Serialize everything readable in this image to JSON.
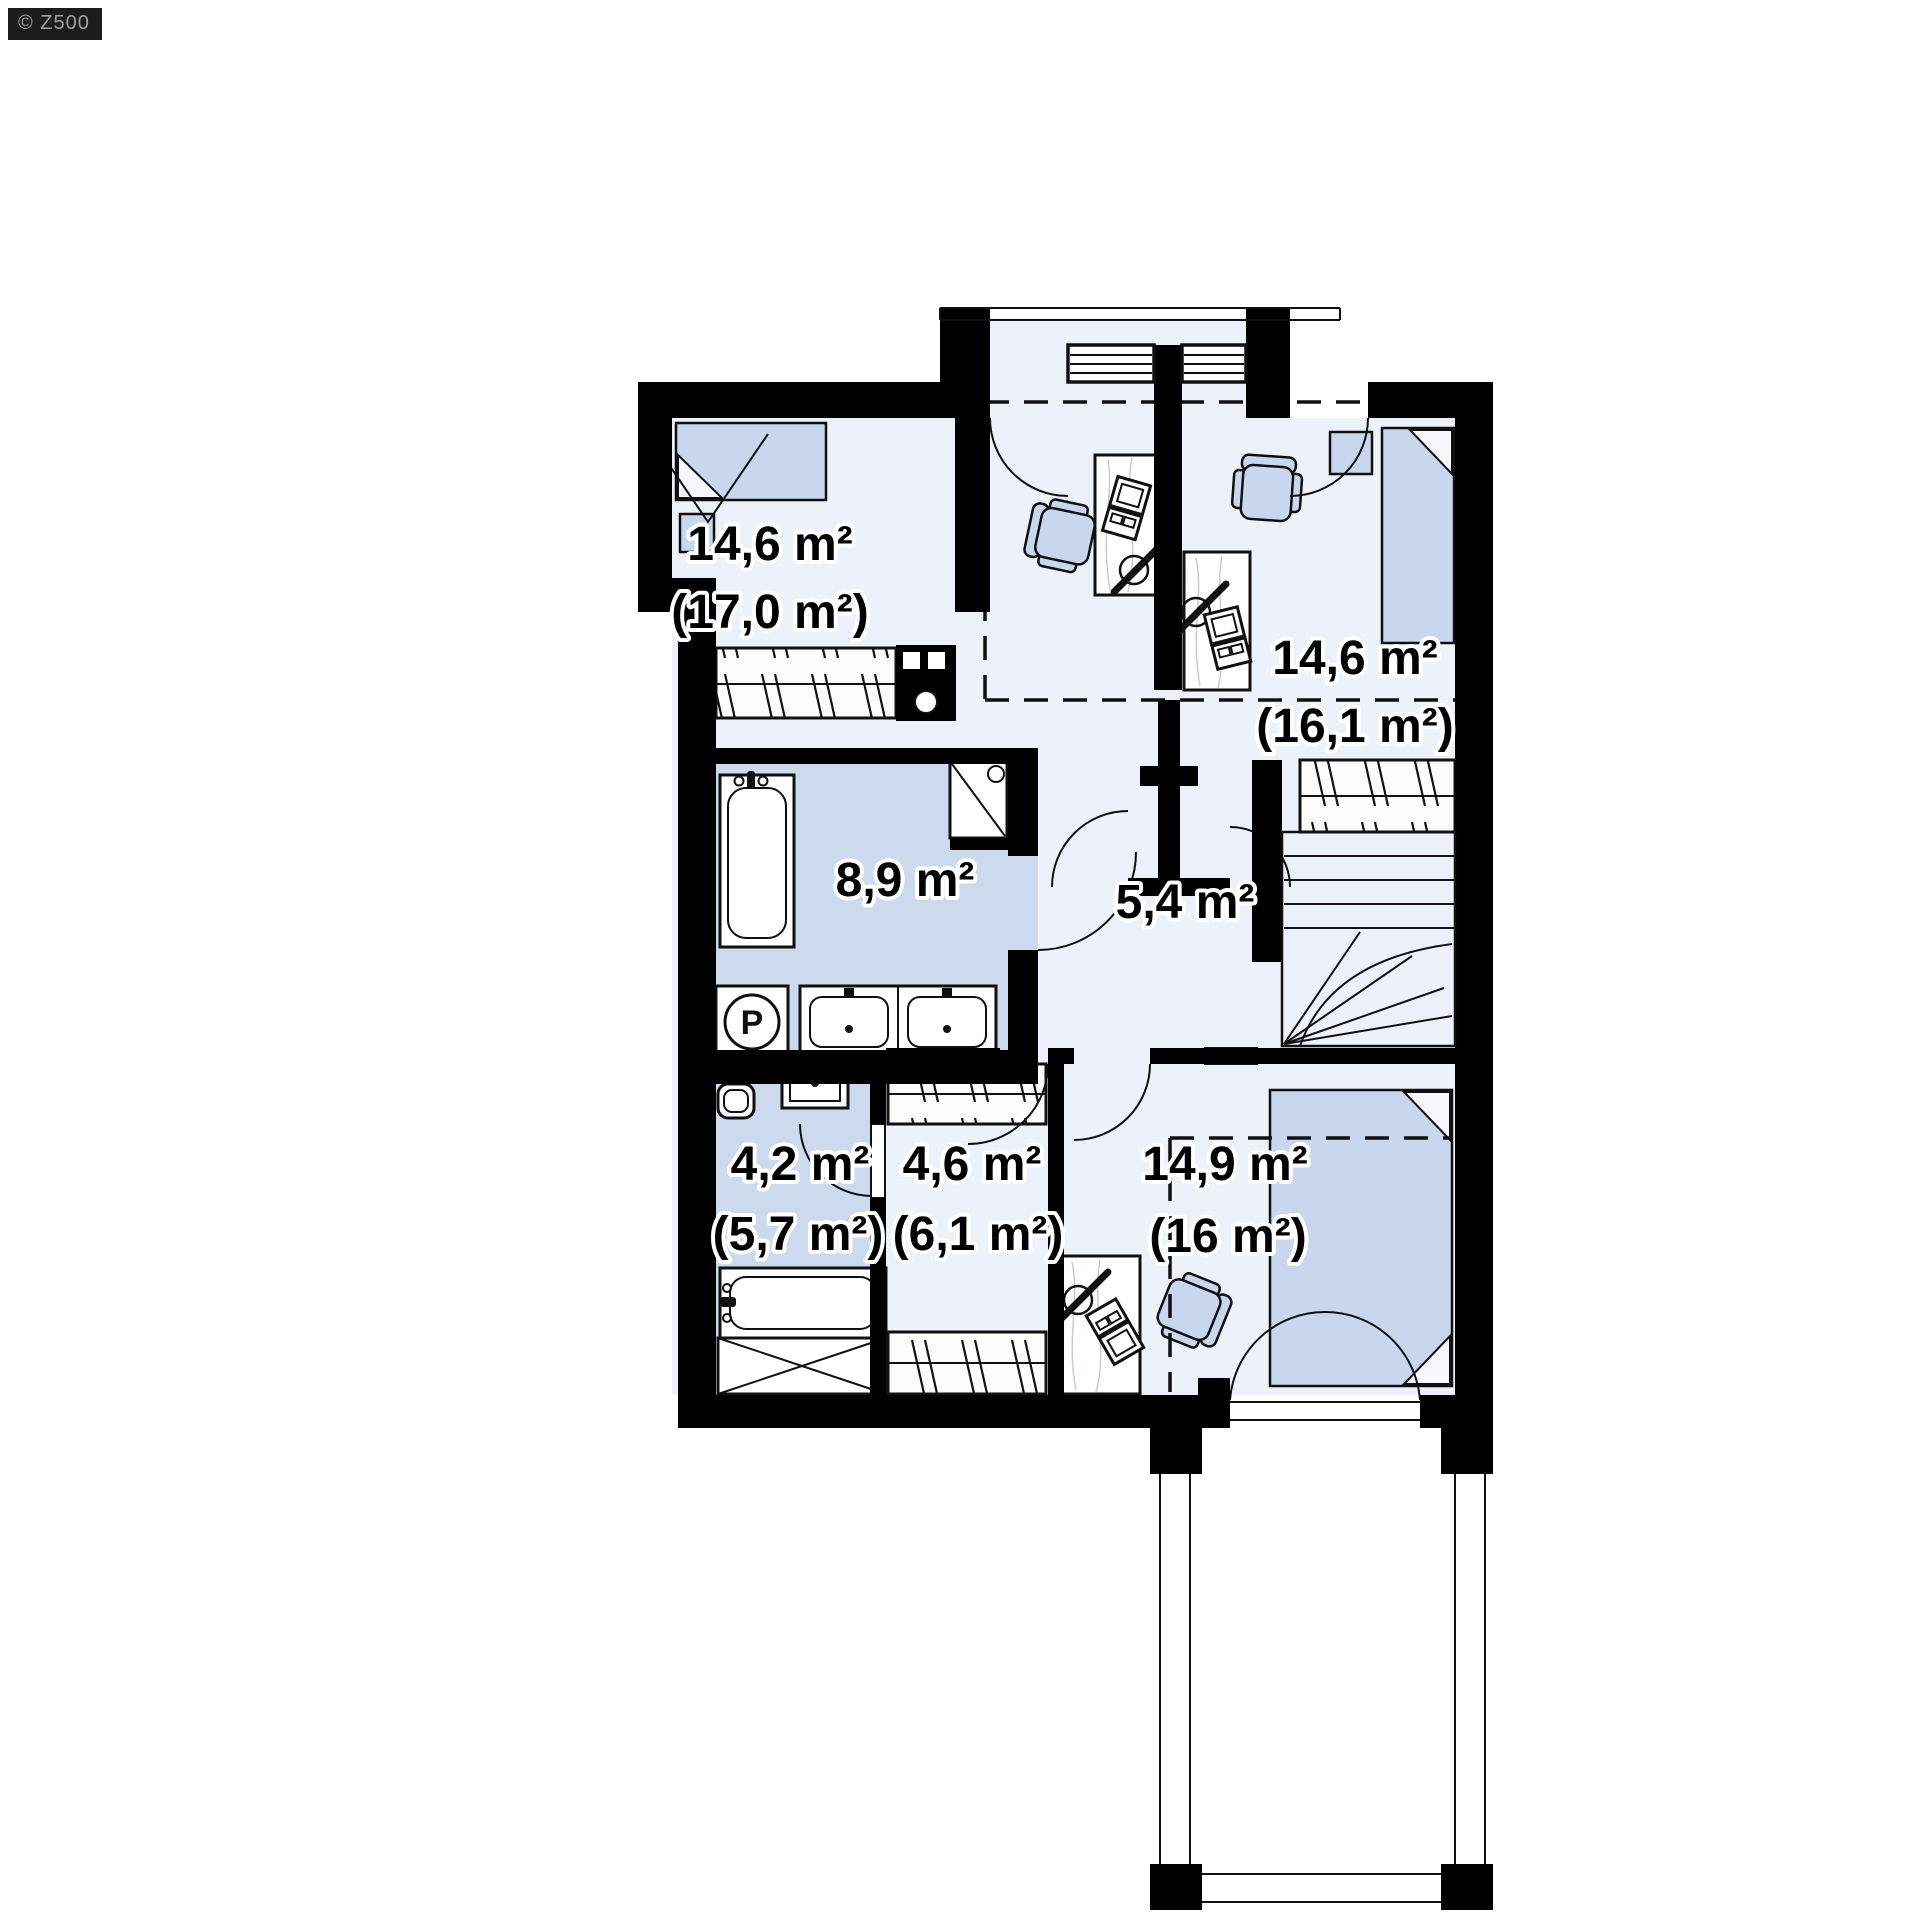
{
  "watermark": {
    "label": "© Z500"
  },
  "plan": {
    "type": "floor-plan-upper-storey",
    "rooms": [
      {
        "name": "bedroom-top-left",
        "area": "14,6 m²",
        "area_gross": "(17,0 m²)"
      },
      {
        "name": "bedroom-top-right",
        "area": "14,6 m²",
        "area_gross": "(16,1 m²)"
      },
      {
        "name": "bathroom",
        "area": "8,9 m²"
      },
      {
        "name": "hall",
        "area": "5,4 m²"
      },
      {
        "name": "wc-laundry",
        "area": "4,2 m²",
        "area_gross": "(5,7 m²)"
      },
      {
        "name": "wardrobe",
        "area": "4,6 m²",
        "area_gross": "(6,1 m²)"
      },
      {
        "name": "bedroom-bottom",
        "area": "14,9 m²",
        "area_gross": "(16 m²)"
      }
    ],
    "symbols": {
      "washing_machine": "P"
    },
    "colors": {
      "wall": "#000000",
      "room": "#edf1fa",
      "wet": "#cdd9ed",
      "furn": "#c9d7ee"
    }
  }
}
